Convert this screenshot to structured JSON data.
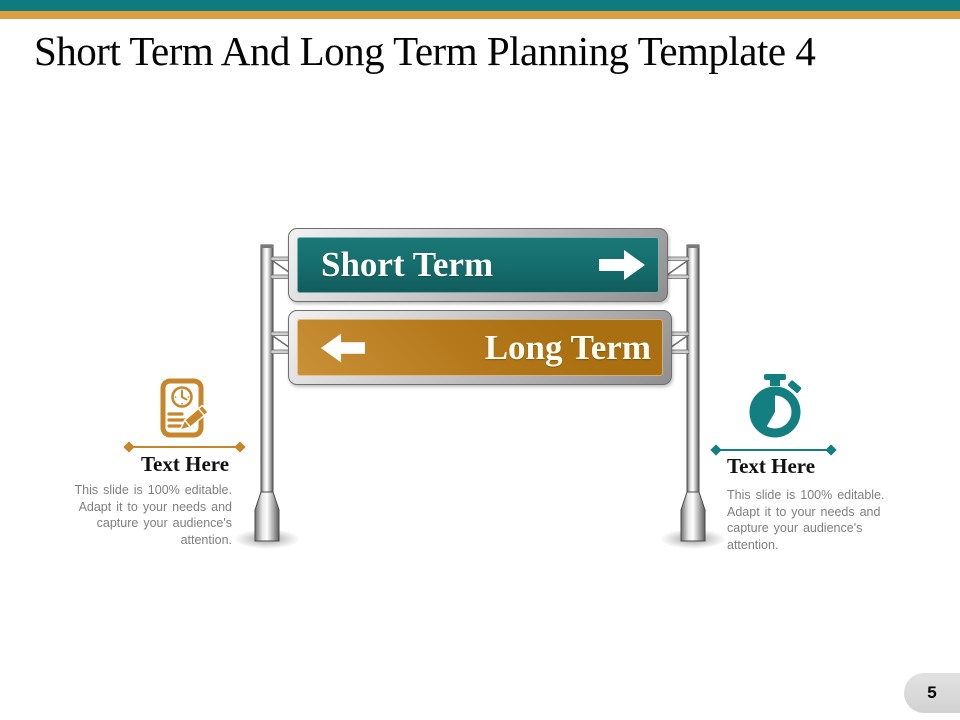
{
  "slide": {
    "title": "Short Term And Long Term Planning Template 4",
    "page_number": "5"
  },
  "colors": {
    "accent-teal": "#0e7c7e",
    "accent-orange": "#dd9d43",
    "sign-teal": "#166f6f",
    "sign-orange": "#b5791c",
    "icon-orange": "#c8862b",
    "icon-teal": "#137f80",
    "text-gray": "#7f7f7f",
    "pill-gray": "#d2d2d2"
  },
  "signs": [
    {
      "label": "Short Term",
      "direction": "right",
      "panel_color": "#166f6f"
    },
    {
      "label": "Long Term",
      "direction": "left",
      "panel_color": "#b5791c"
    }
  ],
  "features": [
    {
      "icon": "document-clock-pencil-icon",
      "title": "Text Here",
      "description": "This slide is 100% editable.\nAdapt it to your needs and\ncapture your audience's\nattention."
    },
    {
      "icon": "stopwatch-icon",
      "title": "Text Here",
      "description": "This slide is 100% editable.\nAdapt it to your needs and\ncapture your audience's\nattention."
    }
  ]
}
